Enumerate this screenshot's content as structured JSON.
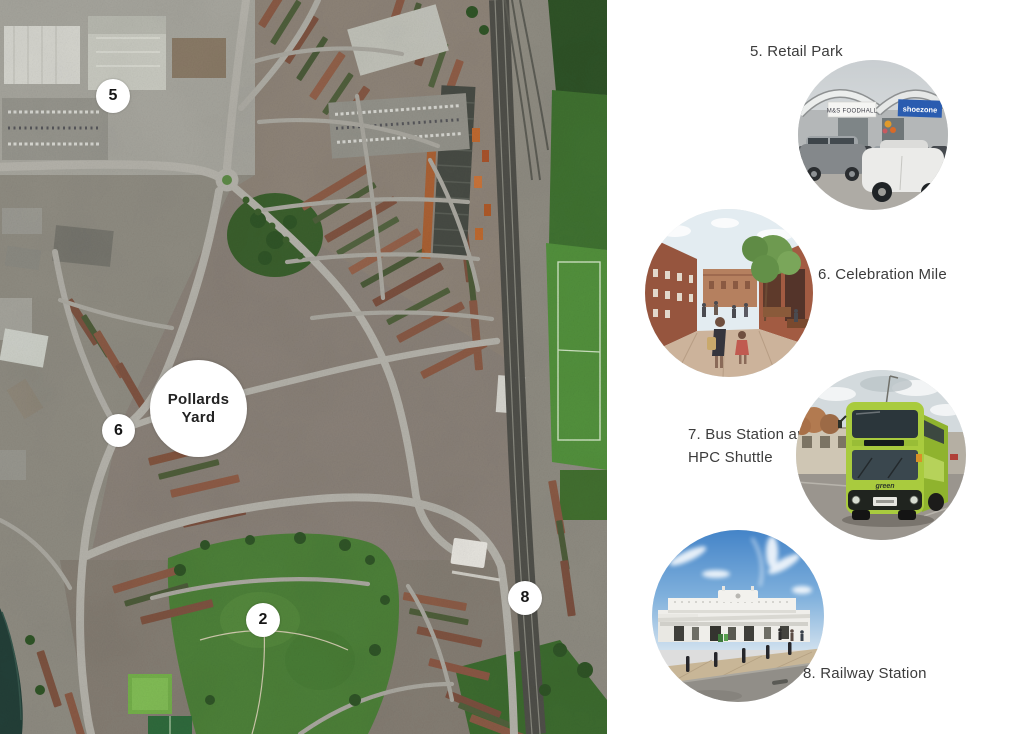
{
  "colors": {
    "background": "#ffffff",
    "label_text": "#3c3c3c",
    "marker_circle": "#ffffff",
    "bus_green": "#a9cb3e",
    "shoezone_blue": "#2a5cb0",
    "park_green": "#4c8038"
  },
  "map": {
    "pollards_yard": {
      "line1": "Pollards",
      "line2": "Yard"
    },
    "markers": [
      {
        "number": "5"
      },
      {
        "number": "6"
      },
      {
        "number": "2"
      },
      {
        "number": "8"
      }
    ]
  },
  "panel": {
    "retail_park_label": "5. Retail Park",
    "celebration_mile_label": "6. Celebration Mile",
    "bus_station_label_line1": "7. Bus Station and",
    "bus_station_label_line2": "HPC Shuttle",
    "railway_station_label": "8. Railway Station"
  },
  "photos": {
    "retail_park": {
      "sign_ms": "M&S FOODHALL",
      "sign_shoezone": "shoezone"
    },
    "bus": {
      "brand": "green"
    }
  }
}
